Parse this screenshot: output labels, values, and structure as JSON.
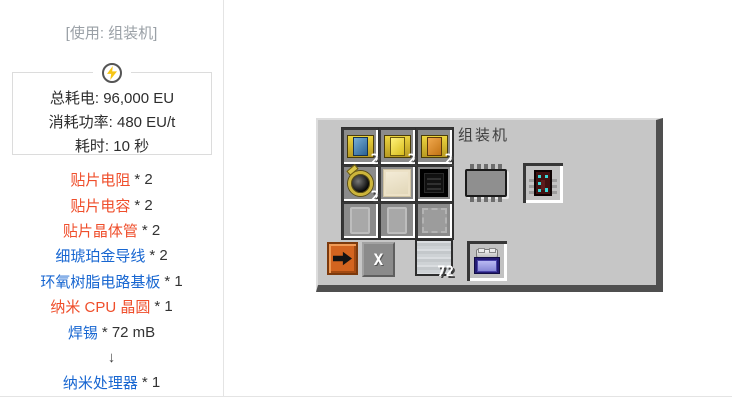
{
  "header": {
    "title": "[使用: 组装机]"
  },
  "energy": {
    "icon": "lightning-icon",
    "total": "总耗电: 96,000 EU",
    "rate": "消耗功率: 480 EU/t",
    "time": "耗时: 10 秒"
  },
  "recipe_list": {
    "arrow": "↓",
    "items": [
      {
        "label": "贴片电阻",
        "qty": "* 2",
        "color": "red"
      },
      {
        "label": "贴片电容",
        "qty": "* 2",
        "color": "red"
      },
      {
        "label": "贴片晶体管",
        "qty": "* 2",
        "color": "red"
      },
      {
        "label": "细琥珀金导线",
        "qty": "* 2",
        "color": "blue"
      },
      {
        "label": "环氧树脂电路基板",
        "qty": "* 1",
        "color": "blue"
      },
      {
        "label": "纳米 CPU 晶圆",
        "qty": "* 1",
        "color": "red"
      },
      {
        "label": "焊锡",
        "qty": "* 72 mB",
        "color": "blue"
      },
      {
        "label": "纳米处理器",
        "qty": "* 1",
        "color": "blue"
      }
    ]
  },
  "machine": {
    "title": "组装机",
    "grid": [
      [
        {
          "item": "smd-component-blue",
          "count": "2"
        },
        {
          "item": "smd-component-yellow",
          "count": "2"
        },
        {
          "item": "smd-component-orange",
          "count": "2"
        }
      ],
      [
        {
          "item": "fine-electrum-wire",
          "count": "2"
        },
        {
          "item": "epoxy-circuit-board",
          "count": ""
        },
        {
          "item": "nano-cpu-wafer",
          "count": ""
        }
      ],
      [
        {
          "item": "ghost-circuit-board",
          "count": ""
        },
        {
          "item": "ghost-circuit-board",
          "count": ""
        },
        {
          "item": "ghost-chip",
          "count": ""
        }
      ]
    ],
    "fluid_slot": {
      "item": "solder",
      "count": "72"
    },
    "output_slot": {
      "item": "nano-processor"
    },
    "battery_slot": {
      "item": "battery"
    },
    "progress_icon": "chip-progress-icon",
    "buttons": {
      "transfer_icon": "arrow-right-icon",
      "clear_label": "X"
    }
  },
  "colors": {
    "link_red": "#ef4e2b",
    "link_blue": "#1766d1",
    "header_gray": "#9aa0a6",
    "panel_body": "#c6c6c6",
    "panel_shadow": "#4f4f4f",
    "title_text": "#3f3f3f",
    "slot_fill": "#8b8b8b",
    "bolt_yellow": "#f6c514"
  }
}
